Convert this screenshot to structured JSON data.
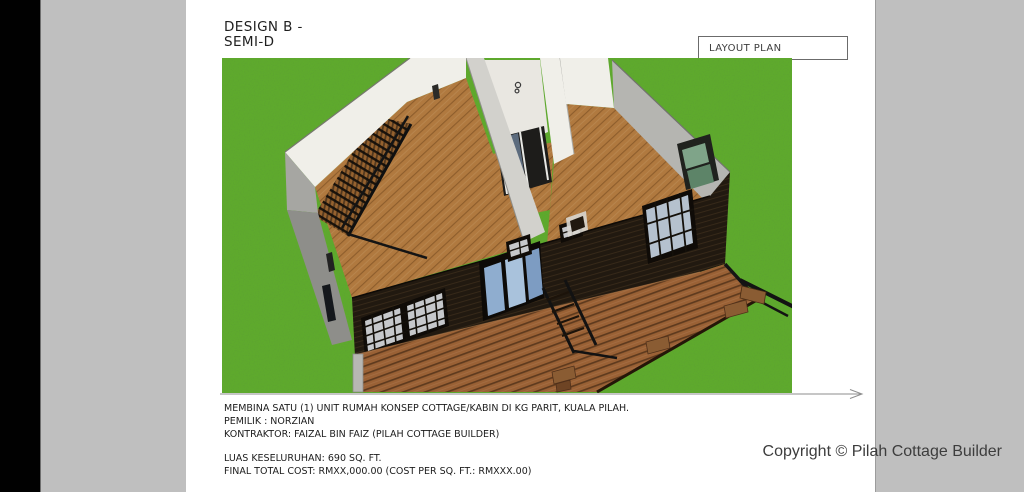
{
  "page": {
    "title_line1": "DESIGN B -",
    "title_line2": "SEMI-D",
    "plan_label": "LAYOUT PLAN"
  },
  "notes": {
    "line1": "MEMBINA SATU (1) UNIT RUMAH KONSEP COTTAGE/KABIN DI KG PARIT, KUALA PILAH.",
    "line2": "PEMILIK : NORZIAN",
    "line3": "KONTRAKTOR: FAIZAL BIN FAIZ (PILAH COTTAGE BUILDER)",
    "line4": "LUAS KESELURUHAN: 690 SQ. FT.",
    "line5": "FINAL TOTAL COST: RMXX,000.00 (COST PER SQ. FT.: RMXXX.00)"
  },
  "footer": {
    "copyright": "Copyright © Pilah Cottage Builder"
  },
  "scene": {
    "description": "3D cutaway perspective of a semi-detached cottage: white rear walls, wood plank floors, interior staircase, dark timber facade with grid windows and blue sliding doors, front timber deck with black railings on a green lawn",
    "door_knob_symbol": "8",
    "colors": {
      "grass": "#5fae2a",
      "wall": "#f0efe9",
      "wall_mid": "#d2d1cc",
      "wall_gray": "#b5b5b1",
      "hall": "#e9e7e1",
      "floor": "#b0793f",
      "floor_line": "#8d5d2c",
      "deck": "#9a6135",
      "deck_line": "#5e3a1e",
      "facade": "#211910",
      "facade_line": "#382a1a",
      "stair": "#96622f",
      "glass": "#c6c8cb",
      "glass_blue": "#8fadcf",
      "glass_green": "#7fa489"
    }
  }
}
